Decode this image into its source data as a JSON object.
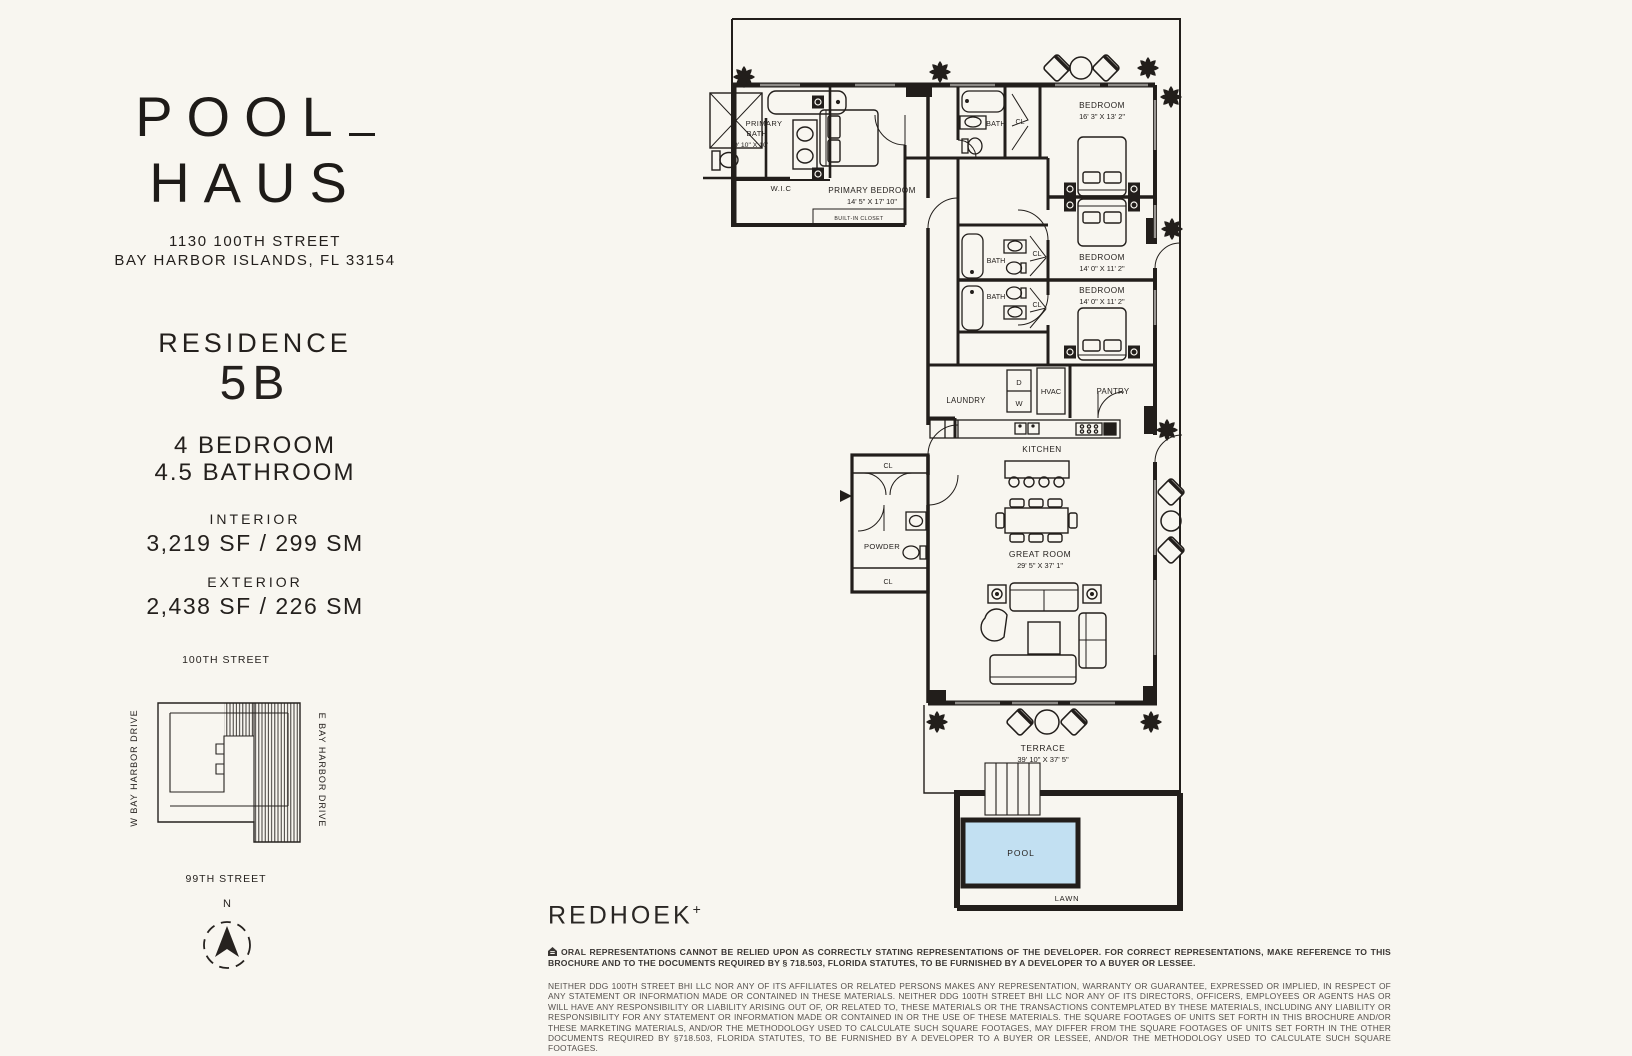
{
  "brand": {
    "logo_line1": "POOL",
    "logo_line2": "HAUS",
    "address_line1": "1130 100TH STREET",
    "address_line2": "BAY HARBOR ISLANDS, FL 33154"
  },
  "residence": {
    "label": "RESIDENCE",
    "unit": "5B",
    "bedrooms": "4 BEDROOM",
    "bathrooms": "4.5 BATHROOM",
    "interior_label": "INTERIOR",
    "interior_area": "3,219 SF / 299 SM",
    "exterior_label": "EXTERIOR",
    "exterior_area": "2,438 SF / 226 SM"
  },
  "keymap": {
    "street_top": "100TH STREET",
    "street_bottom": "99TH STREET",
    "street_left": "W BAY HARBOR DRIVE",
    "street_right": "E BAY HARBOR DRIVE",
    "compass_north": "N"
  },
  "floorplan": {
    "primary_bath_line1": "PRIMARY",
    "primary_bath_line2": "BATH",
    "primary_bath_dims": "9' 10\" X 10'",
    "wic": "W.I.C",
    "primary_bedroom": "PRIMARY BEDROOM",
    "primary_bedroom_dims": "14' 5\" X 17' 10\"",
    "built_in_closet": "BUILT-IN CLOSET",
    "bath": "BATH",
    "cl": "CL",
    "bedroom": "BEDROOM",
    "bedroom1_dims": "16' 3\" X 13' 2\"",
    "bedroom2_dims": "14' 0\" X 11' 2\"",
    "bedroom3_dims": "14' 0\" X 11' 2\"",
    "laundry": "LAUNDRY",
    "dryer": "D",
    "washer": "W",
    "hvac": "HVAC",
    "pantry": "PANTRY",
    "kitchen": "KITCHEN",
    "great_room": "GREAT ROOM",
    "great_room_dims": "29' 5\" X 37' 1\"",
    "powder": "POWDER",
    "terrace": "TERRACE",
    "terrace_dims": "39' 10\" X 37' 5\"",
    "pool": "POOL",
    "lawn": "LAWN"
  },
  "footer": {
    "logo": "REDHOEK",
    "logo_plus": "+",
    "disclaimer1": "ORAL REPRESENTATIONS CANNOT BE RELIED UPON AS CORRECTLY STATING REPRESENTATIONS OF THE DEVELOPER. FOR CORRECT REPRESENTATIONS, MAKE REFERENCE TO THIS BROCHURE AND TO THE DOCUMENTS REQUIRED BY § 718.503, FLORIDA STATUTES, TO BE FURNISHED BY A DEVELOPER TO A BUYER OR LESSEE.",
    "disclaimer2": "NEITHER DDG 100TH STREET BHI LLC NOR ANY OF ITS AFFILIATES OR RELATED PERSONS MAKES ANY REPRESENTATION, WARRANTY OR GUARANTEE, EXPRESSED OR IMPLIED, IN RESPECT OF ANY STATEMENT OR INFORMATION MADE OR CONTAINED IN THESE MATERIALS. NEITHER DDG 100TH STREET BHI LLC NOR ANY OF ITS DIRECTORS, OFFICERS, EMPLOYEES OR AGENTS HAS OR WILL HAVE ANY RESPONSIBILITY OR LIABILITY ARISING OUT OF, OR RELATED TO, THESE MATERIALS OR THE TRANSACTIONS CONTEMPLATED BY THESE MATERIALS, INCLUDING ANY LIABILITY OR RESPONSIBILITY FOR ANY STATEMENT OR INFORMATION MADE OR CONTAINED IN OR THE USE OF THESE MATERIALS. THE SQUARE FOOTAGES OF UNITS SET FORTH IN THIS BROCHURE AND/OR THESE MARKETING MATERIALS, AND/OR THE METHODOLOGY USED TO CALCULATE SUCH SQUARE FOOTAGES, MAY DIFFER FROM THE SQUARE FOOTAGES OF UNITS SET FORTH IN THE OTHER DOCUMENTS REQUIRED BY §718.503, FLORIDA STATUTES, TO BE FURNISHED BY A DEVELOPER TO A BUYER OR LESSEE, AND/OR THE METHODOLOGY USED TO CALCULATE SUCH SQUARE FOOTAGES."
  },
  "colors": {
    "background": "#F8F6F0",
    "ink": "#221E1B",
    "pool_fill": "#C2E0F2"
  }
}
